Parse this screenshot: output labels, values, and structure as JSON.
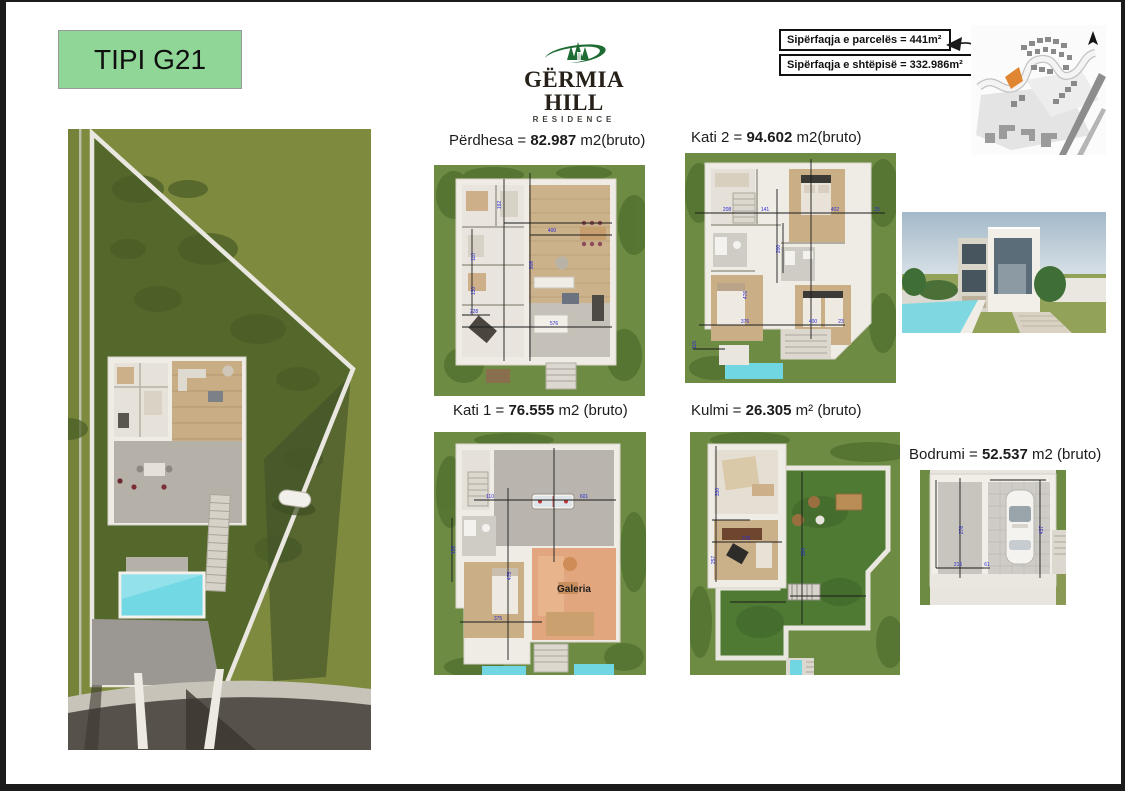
{
  "title_box": {
    "label": "TIPI G21"
  },
  "logo": {
    "title": "GËRMIA HILL",
    "subtitle": "RESIDENCE",
    "icon": "pine-trees-swoosh",
    "brand_green": "#1e6b33"
  },
  "info_panel": {
    "parcel_area": "Sipërfaqja e parcelës = 441m²",
    "house_area": "Sipërfaqja e shtëpisë = 332.986m²"
  },
  "site_map": {
    "highlight_color": "#e08632"
  },
  "plans": {
    "perdhesa": {
      "prefix": "Përdhesa = ",
      "value": "82.987",
      "suffix": " m2(bruto)",
      "dims": [
        "400",
        "908",
        "576",
        "228",
        "110",
        "130",
        "192"
      ]
    },
    "kati2": {
      "prefix": "Kati 2 = ",
      "value": "94.602",
      "suffix": " m2(bruto)",
      "dims": [
        "208",
        "141",
        "402",
        "25",
        "200",
        "476",
        "376",
        "400",
        "23",
        "115"
      ]
    },
    "kati1": {
      "prefix": "Kati 1 = ",
      "value": "76.555",
      "suffix": " m2 (bruto)",
      "overlay_label": "Galeria",
      "dims": [
        "475",
        "375",
        "110",
        "601",
        "188"
      ]
    },
    "kulmi": {
      "prefix": "Kulmi = ",
      "value": "26.305",
      "suffix": " m² (bruto)",
      "dims": [
        "330",
        "257",
        "278",
        "304"
      ]
    },
    "bodrumi": {
      "prefix": "Bodrumi = ",
      "value": "52.537",
      "suffix": " m2 (bruto)",
      "dims": [
        "276",
        "216",
        "61",
        "437"
      ]
    }
  }
}
